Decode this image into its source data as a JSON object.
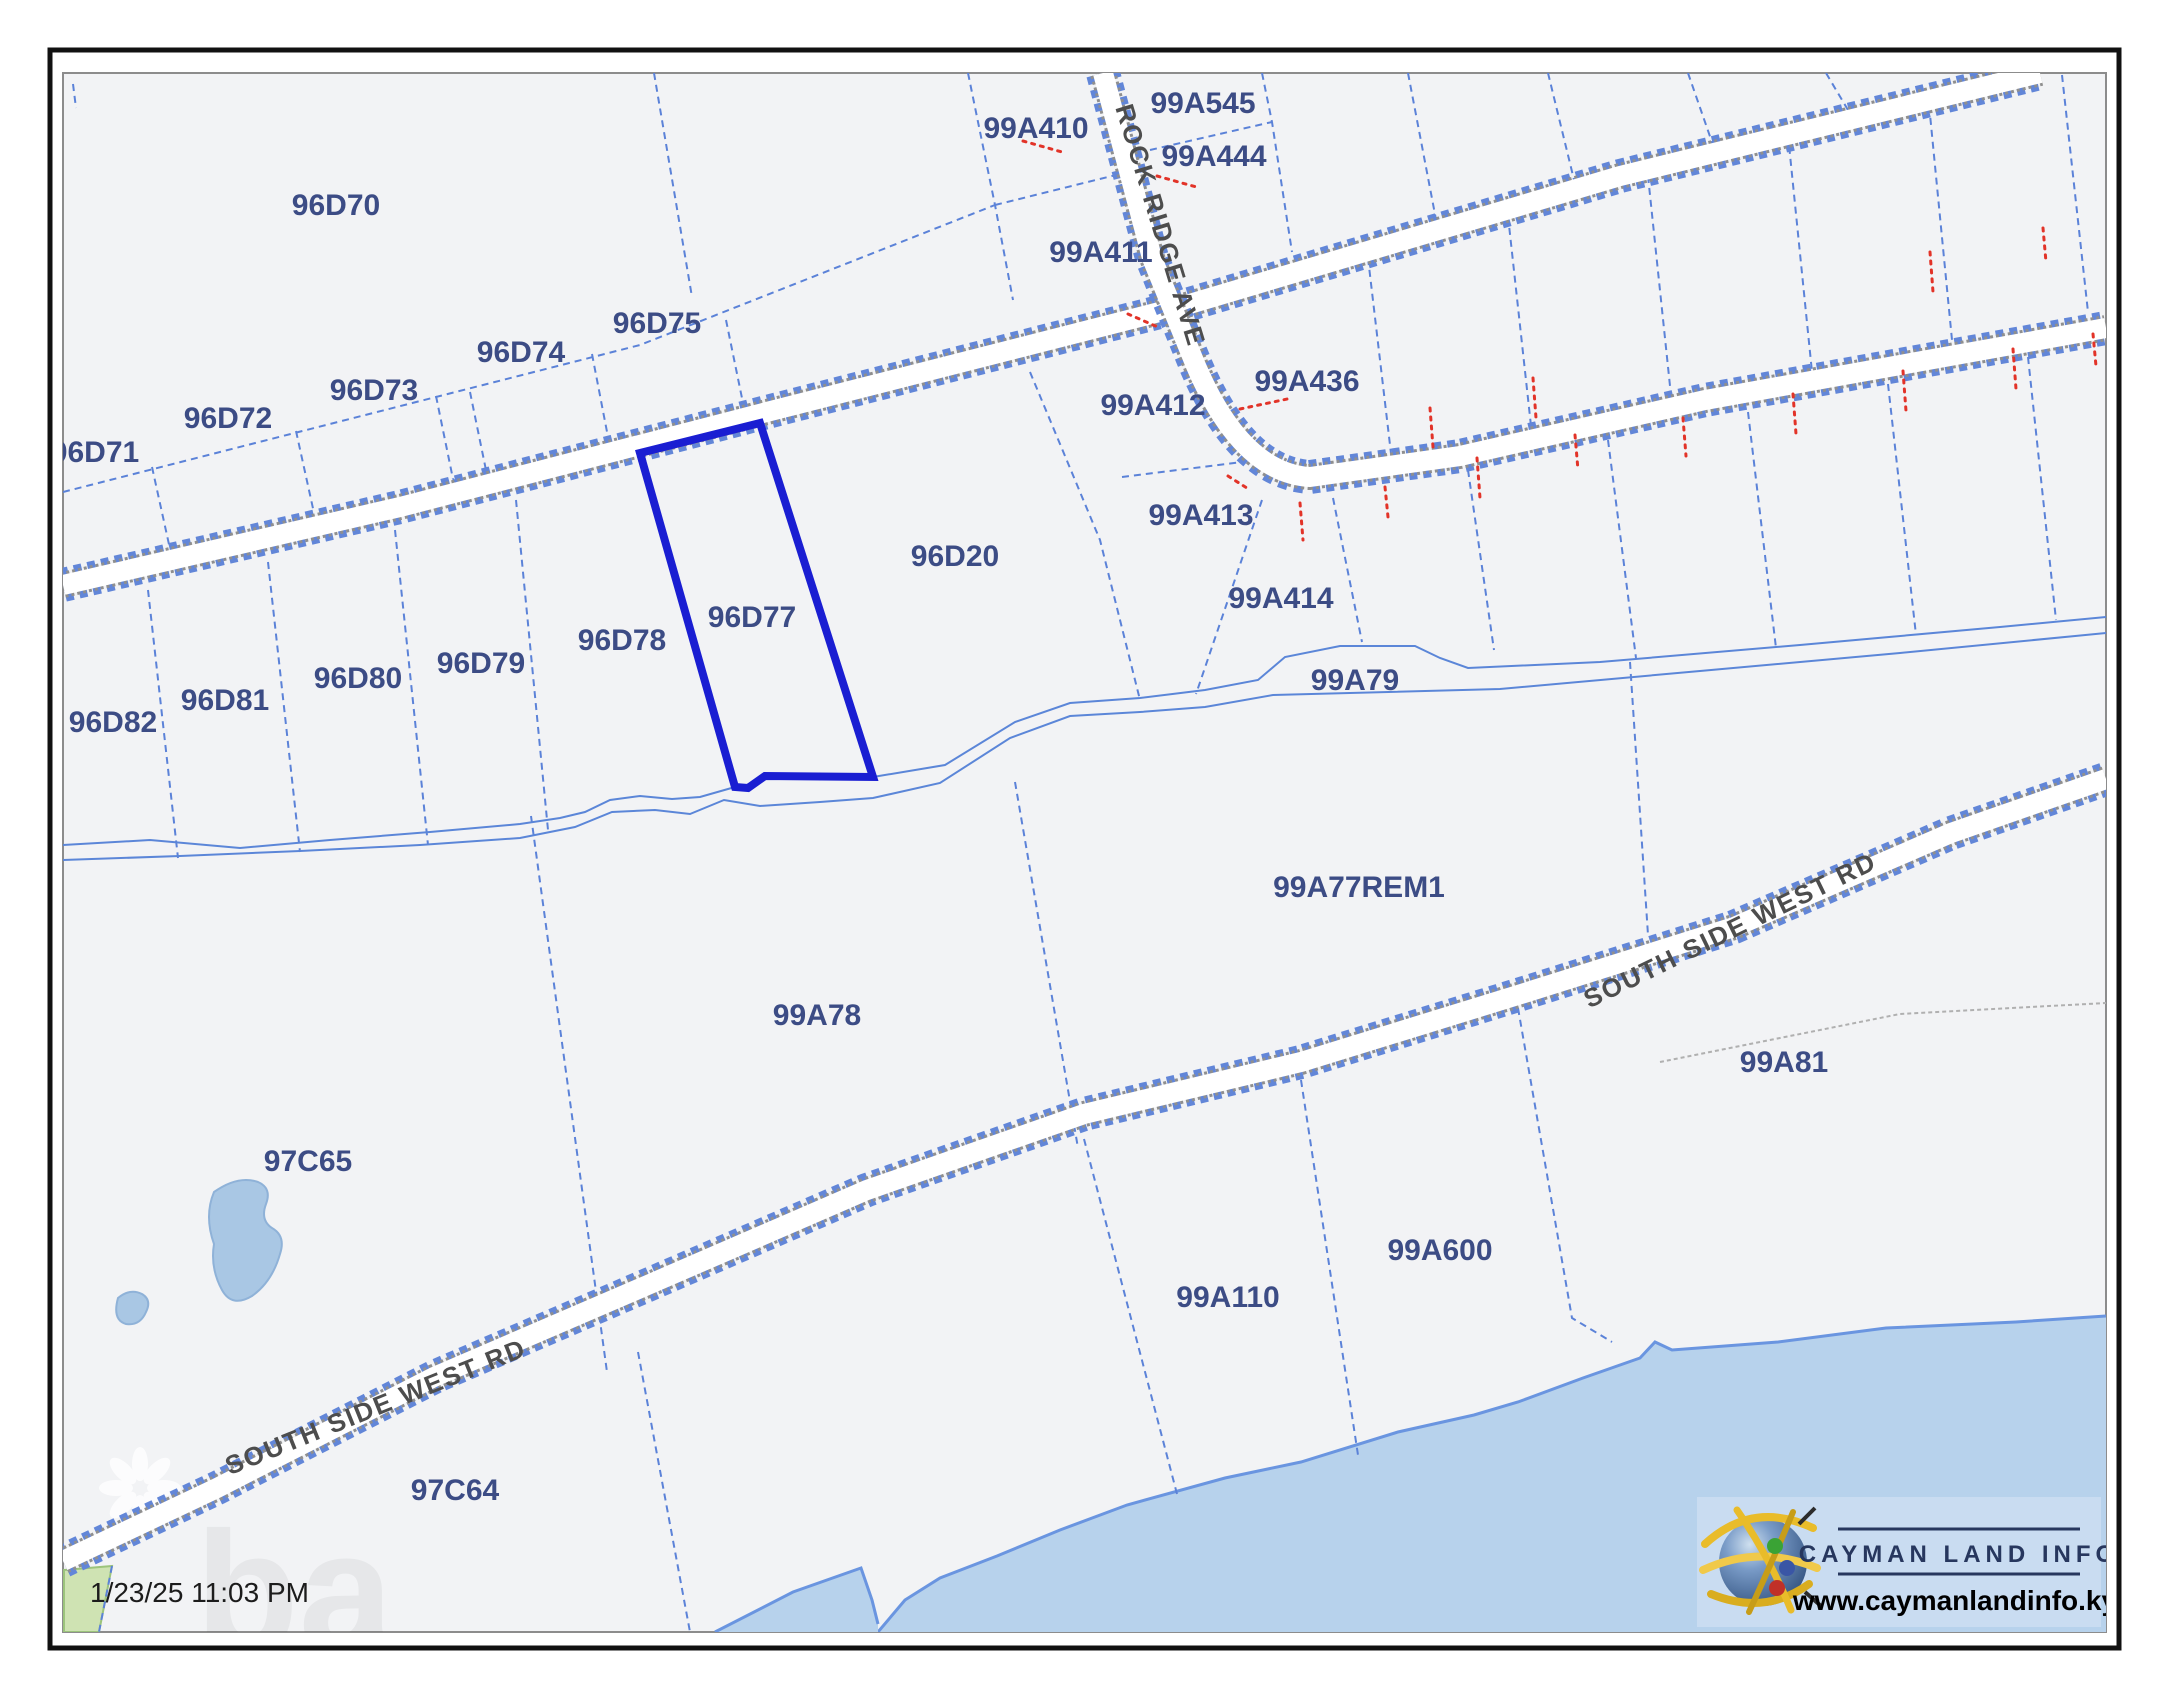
{
  "map": {
    "title": "Cayman Land Info cadastral parcel map",
    "highlighted_parcel": "96D77",
    "timestamp": "1/23/25 11:03 PM",
    "parcels": [
      {
        "id": "96D70"
      },
      {
        "id": "96D71"
      },
      {
        "id": "96D72"
      },
      {
        "id": "96D73"
      },
      {
        "id": "96D74"
      },
      {
        "id": "96D75"
      },
      {
        "id": "96D77"
      },
      {
        "id": "96D78"
      },
      {
        "id": "96D79"
      },
      {
        "id": "96D80"
      },
      {
        "id": "96D81"
      },
      {
        "id": "96D82"
      },
      {
        "id": "96D20"
      },
      {
        "id": "99A410"
      },
      {
        "id": "99A545"
      },
      {
        "id": "99A444"
      },
      {
        "id": "99A411"
      },
      {
        "id": "99A412"
      },
      {
        "id": "99A436"
      },
      {
        "id": "99A413"
      },
      {
        "id": "99A414"
      },
      {
        "id": "99A79"
      },
      {
        "id": "99A77REM1"
      },
      {
        "id": "99A78"
      },
      {
        "id": "97C65"
      },
      {
        "id": "99A81"
      },
      {
        "id": "99A600"
      },
      {
        "id": "99A110"
      },
      {
        "id": "97C64"
      }
    ],
    "roads": {
      "rock_ridge_ave": "ROCK RIDGE AVE",
      "south_side_west_rd_east": "SOUTH SIDE WEST RD",
      "south_side_west_rd_west": "SOUTH SIDE WEST RD"
    },
    "colors": {
      "map_background": "#f2f3f5",
      "parcel_line": "#5b82d8",
      "highlight": "#1a1ed2",
      "sea": "#b7d2ec",
      "pond": "#a9c7e4",
      "green_parcel": "#cfe3b3",
      "unsurveyed_boundary_red": "#e23328",
      "label_text": "#3c4c85"
    }
  },
  "logo": {
    "title": "CAYMAN LAND INFO",
    "url": "www.caymanlandinfo.ky",
    "globe_icon": "globe-icon"
  }
}
